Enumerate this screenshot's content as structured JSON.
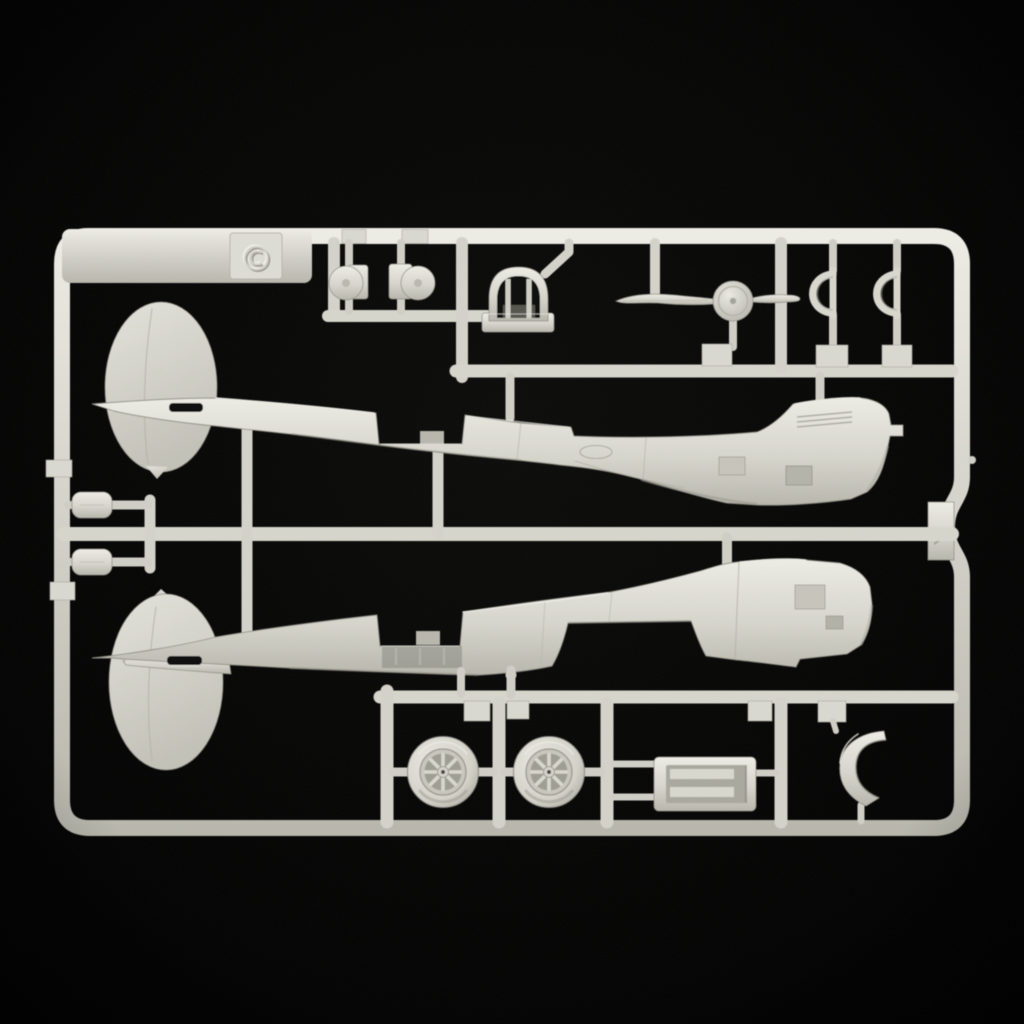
{
  "scene": {
    "type": "product-photo",
    "subject": "aircraft plastic model kit sprue on black background",
    "background_center": "#0c0c0b",
    "background_edge": "#000000",
    "plastic_light": "#ecebe4",
    "plastic_base": "#d6d5cc",
    "plastic_mid": "#b7b6ac",
    "plastic_shadow": "#8e8d83",
    "recess_color": "#0b0b09"
  },
  "markings": {
    "copyright_symbol": "©"
  },
  "sprue": {
    "material": "light-gray styrene",
    "parts": [
      {
        "name": "fuselage-half-upper"
      },
      {
        "name": "fuselage-half-lower"
      },
      {
        "name": "propeller-with-spinner"
      },
      {
        "name": "cockpit-headrest-frame"
      },
      {
        "name": "main-wheel-1"
      },
      {
        "name": "main-wheel-2"
      },
      {
        "name": "cowl-ring-half-1"
      },
      {
        "name": "cowl-ring-half-2"
      },
      {
        "name": "radiator-housing"
      },
      {
        "name": "cowl-flap-segment"
      },
      {
        "name": "fairing-small-1"
      },
      {
        "name": "fairing-small-2"
      },
      {
        "name": "fairing-oval-1"
      },
      {
        "name": "fairing-oval-2"
      }
    ]
  }
}
